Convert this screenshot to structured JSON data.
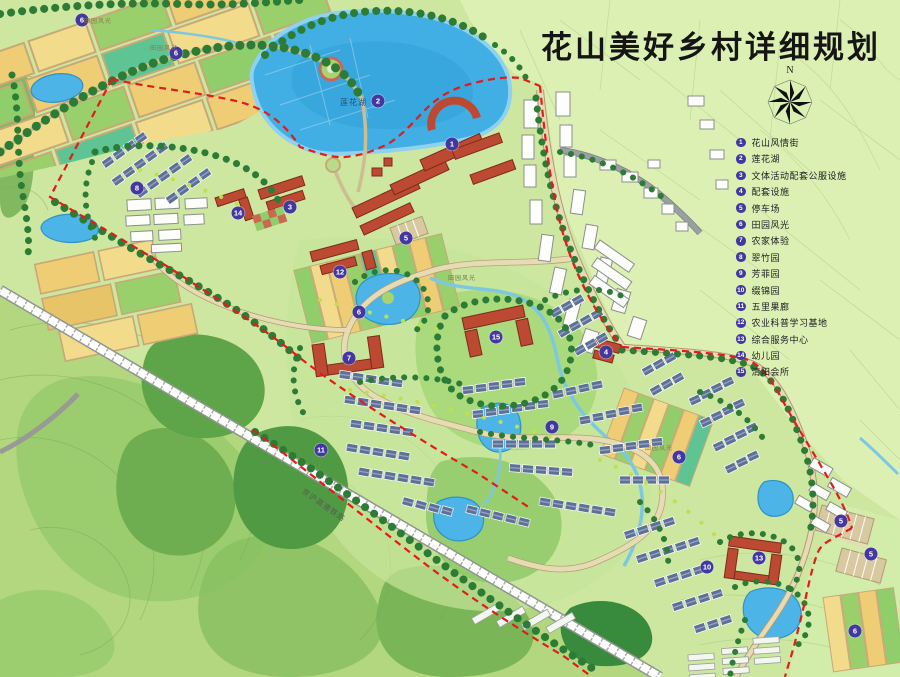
{
  "title": "花山美好乡村详细规划",
  "compass": {
    "label": "N"
  },
  "legend": {
    "items": [
      {
        "num": "1",
        "label": "花山风情街"
      },
      {
        "num": "2",
        "label": "莲花湖"
      },
      {
        "num": "3",
        "label": "文体活动配套公服设施"
      },
      {
        "num": "4",
        "label": "配套设施"
      },
      {
        "num": "5",
        "label": "停车场"
      },
      {
        "num": "6",
        "label": "田园风光"
      },
      {
        "num": "7",
        "label": "农家体验"
      },
      {
        "num": "8",
        "label": "翠竹园"
      },
      {
        "num": "9",
        "label": "芳菲园"
      },
      {
        "num": "10",
        "label": "缀锦园"
      },
      {
        "num": "11",
        "label": "五里果廊"
      },
      {
        "num": "12",
        "label": "农业科普学习基地"
      },
      {
        "num": "13",
        "label": "综合服务中心"
      },
      {
        "num": "14",
        "label": "幼儿园"
      },
      {
        "num": "15",
        "label": "清阳会所"
      }
    ]
  },
  "map": {
    "markers": [
      {
        "num": "6",
        "x": 82,
        "y": 20
      },
      {
        "num": "6",
        "x": 176,
        "y": 53
      },
      {
        "num": "2",
        "x": 378,
        "y": 101
      },
      {
        "num": "1",
        "x": 452,
        "y": 144
      },
      {
        "num": "8",
        "x": 137,
        "y": 188
      },
      {
        "num": "3",
        "x": 290,
        "y": 207
      },
      {
        "num": "14",
        "x": 238,
        "y": 213
      },
      {
        "num": "5",
        "x": 406,
        "y": 238
      },
      {
        "num": "12",
        "x": 340,
        "y": 272
      },
      {
        "num": "6",
        "x": 359,
        "y": 312
      },
      {
        "num": "15",
        "x": 496,
        "y": 337
      },
      {
        "num": "4",
        "x": 606,
        "y": 352
      },
      {
        "num": "7",
        "x": 349,
        "y": 358
      },
      {
        "num": "9",
        "x": 552,
        "y": 427
      },
      {
        "num": "11",
        "x": 321,
        "y": 450
      },
      {
        "num": "6",
        "x": 679,
        "y": 457
      },
      {
        "num": "5",
        "x": 841,
        "y": 521
      },
      {
        "num": "5",
        "x": 871,
        "y": 554
      },
      {
        "num": "13",
        "x": 759,
        "y": 558
      },
      {
        "num": "10",
        "x": 707,
        "y": 567
      },
      {
        "num": "6",
        "x": 855,
        "y": 631
      }
    ],
    "labels": [
      {
        "text": "莲花湖",
        "x": 340,
        "y": 97,
        "rot": 0,
        "fs": 8,
        "color": "#1f4f73"
      },
      {
        "text": "京沪高速铁路",
        "x": 306,
        "y": 486,
        "rot": 35,
        "fs": 7.5,
        "color": "#5a5a52"
      },
      {
        "text": "田园风光",
        "x": 84,
        "y": 16,
        "rot": 0,
        "fs": 6,
        "color": "#8a7b4a"
      },
      {
        "text": "田园风光",
        "x": 150,
        "y": 43,
        "rot": 0,
        "fs": 6,
        "color": "#8a7b4a"
      },
      {
        "text": "田园风光",
        "x": 448,
        "y": 273,
        "rot": 0,
        "fs": 6,
        "color": "#6a7b4a"
      },
      {
        "text": "田园风光",
        "x": 645,
        "y": 443,
        "rot": 0,
        "fs": 6,
        "color": "#8a7b4a"
      }
    ],
    "colors": {
      "boundary": "#e21b1b",
      "water": "#41aee4",
      "marker": "#43389f",
      "red_roof": "#bc4a32",
      "villa_roof": "#5e7096",
      "field_yellow": "#eecd74",
      "field_green": "#8fce6a",
      "base": "#cde7a0",
      "outside": "#dcf0b4",
      "forest": "#2f7d38",
      "road": "#e7dbb4"
    }
  }
}
